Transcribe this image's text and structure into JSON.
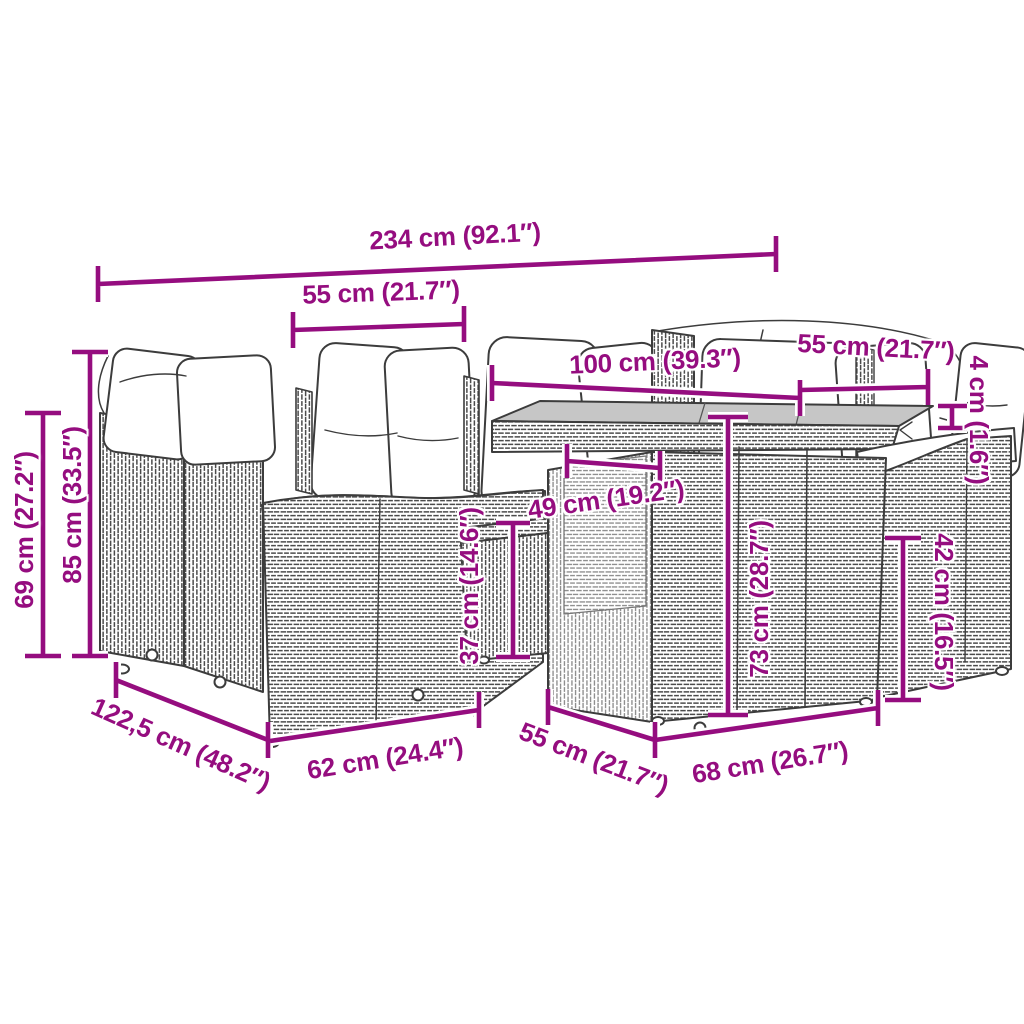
{
  "colors": {
    "dimension_magenta": "#950D7F",
    "line_art_grey": "#3C3C3C",
    "tabletop_grey": "#C6C6C6",
    "background": "#FFFFFF"
  },
  "dimensions": [
    {
      "id": "total-width",
      "label": "234 cm (92.1″)"
    },
    {
      "id": "module-width-top",
      "label": "55 cm (21.7″)"
    },
    {
      "id": "table-width",
      "label": "100 cm (39.3″)"
    },
    {
      "id": "right-module-width",
      "label": "55 cm (21.7″)"
    },
    {
      "id": "tabletop-thickness",
      "label": "4 cm (1.6″)"
    },
    {
      "id": "back-height",
      "label": "69 cm (27.2″)"
    },
    {
      "id": "total-height",
      "label": "85 cm (33.5″)"
    },
    {
      "id": "table-clearance",
      "label": "49 cm (19.2″)"
    },
    {
      "id": "stool-height",
      "label": "37 cm (14.6″)"
    },
    {
      "id": "table-height",
      "label": "73 cm (28.7″)"
    },
    {
      "id": "seat-height",
      "label": "42 cm (16.5″)"
    },
    {
      "id": "sofa-depth",
      "label": "122,5 cm (48.2″)"
    },
    {
      "id": "seat-width",
      "label": "62 cm (24.4″)"
    },
    {
      "id": "module-depth-bottom",
      "label": "55 cm (21.7″)"
    },
    {
      "id": "table-depth",
      "label": "68 cm (26.7″)"
    }
  ]
}
